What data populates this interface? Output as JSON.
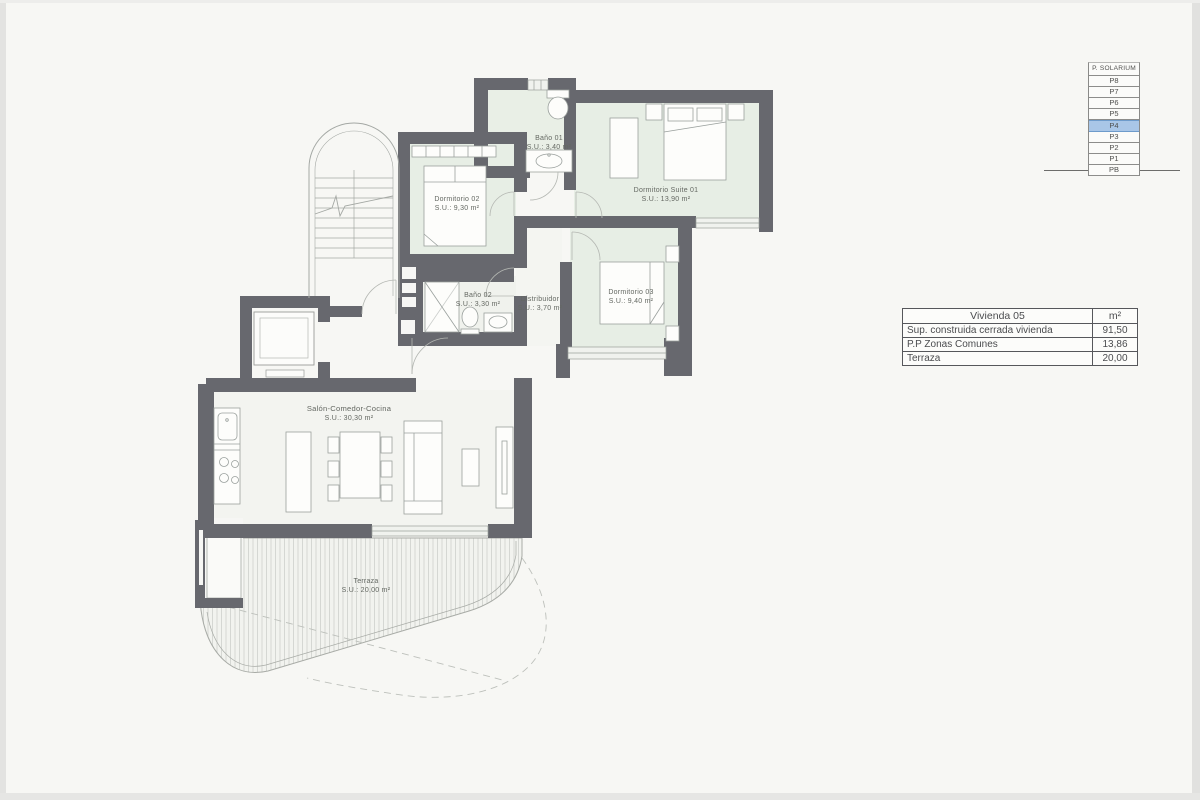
{
  "floor_selector": {
    "header": "P. SOLARIUM",
    "floors": [
      "P8",
      "P7",
      "P6",
      "P5",
      "P4",
      "P3",
      "P2",
      "P1",
      "PB"
    ],
    "selected": "P4"
  },
  "area_table": {
    "title": "Vivienda 05",
    "unit": "m²",
    "rows": [
      {
        "label": "Sup. construida cerrada vivienda",
        "value": "91,50"
      },
      {
        "label": "P.P Zonas Comunes",
        "value": "13,86"
      },
      {
        "label": "Terraza",
        "value": "20,00"
      }
    ]
  },
  "rooms": {
    "bano01": {
      "name": "Baño 01",
      "area": "S.U.: 3,40 m²"
    },
    "dorm02": {
      "name": "Dormitorio 02",
      "area": "S.U.: 9,30 m²"
    },
    "suite01": {
      "name": "Dormitorio Suite 01",
      "area": "S.U.: 13,90 m²"
    },
    "bano02": {
      "name": "Baño 02",
      "area": "S.U.: 3,30 m²"
    },
    "distribuidor": {
      "name": "Distribuidor",
      "area": "S.U.: 3,70 m²"
    },
    "dorm03": {
      "name": "Dormitorio 03",
      "area": "S.U.: 9,40 m²"
    },
    "salon": {
      "name": "Salón-Comedor-Cocina",
      "area": "S.U.: 30,30 m²"
    },
    "terraza": {
      "name": "Terraza",
      "area": "S.U.: 20,00 m²"
    }
  },
  "colors": {
    "wall": "#67686e",
    "room_fill": "#e7eee5",
    "selected_floor_fill": "#a9c6e7",
    "selected_floor_border": "#6e9bcb",
    "terrace_hatch": "#c9ccc8"
  }
}
